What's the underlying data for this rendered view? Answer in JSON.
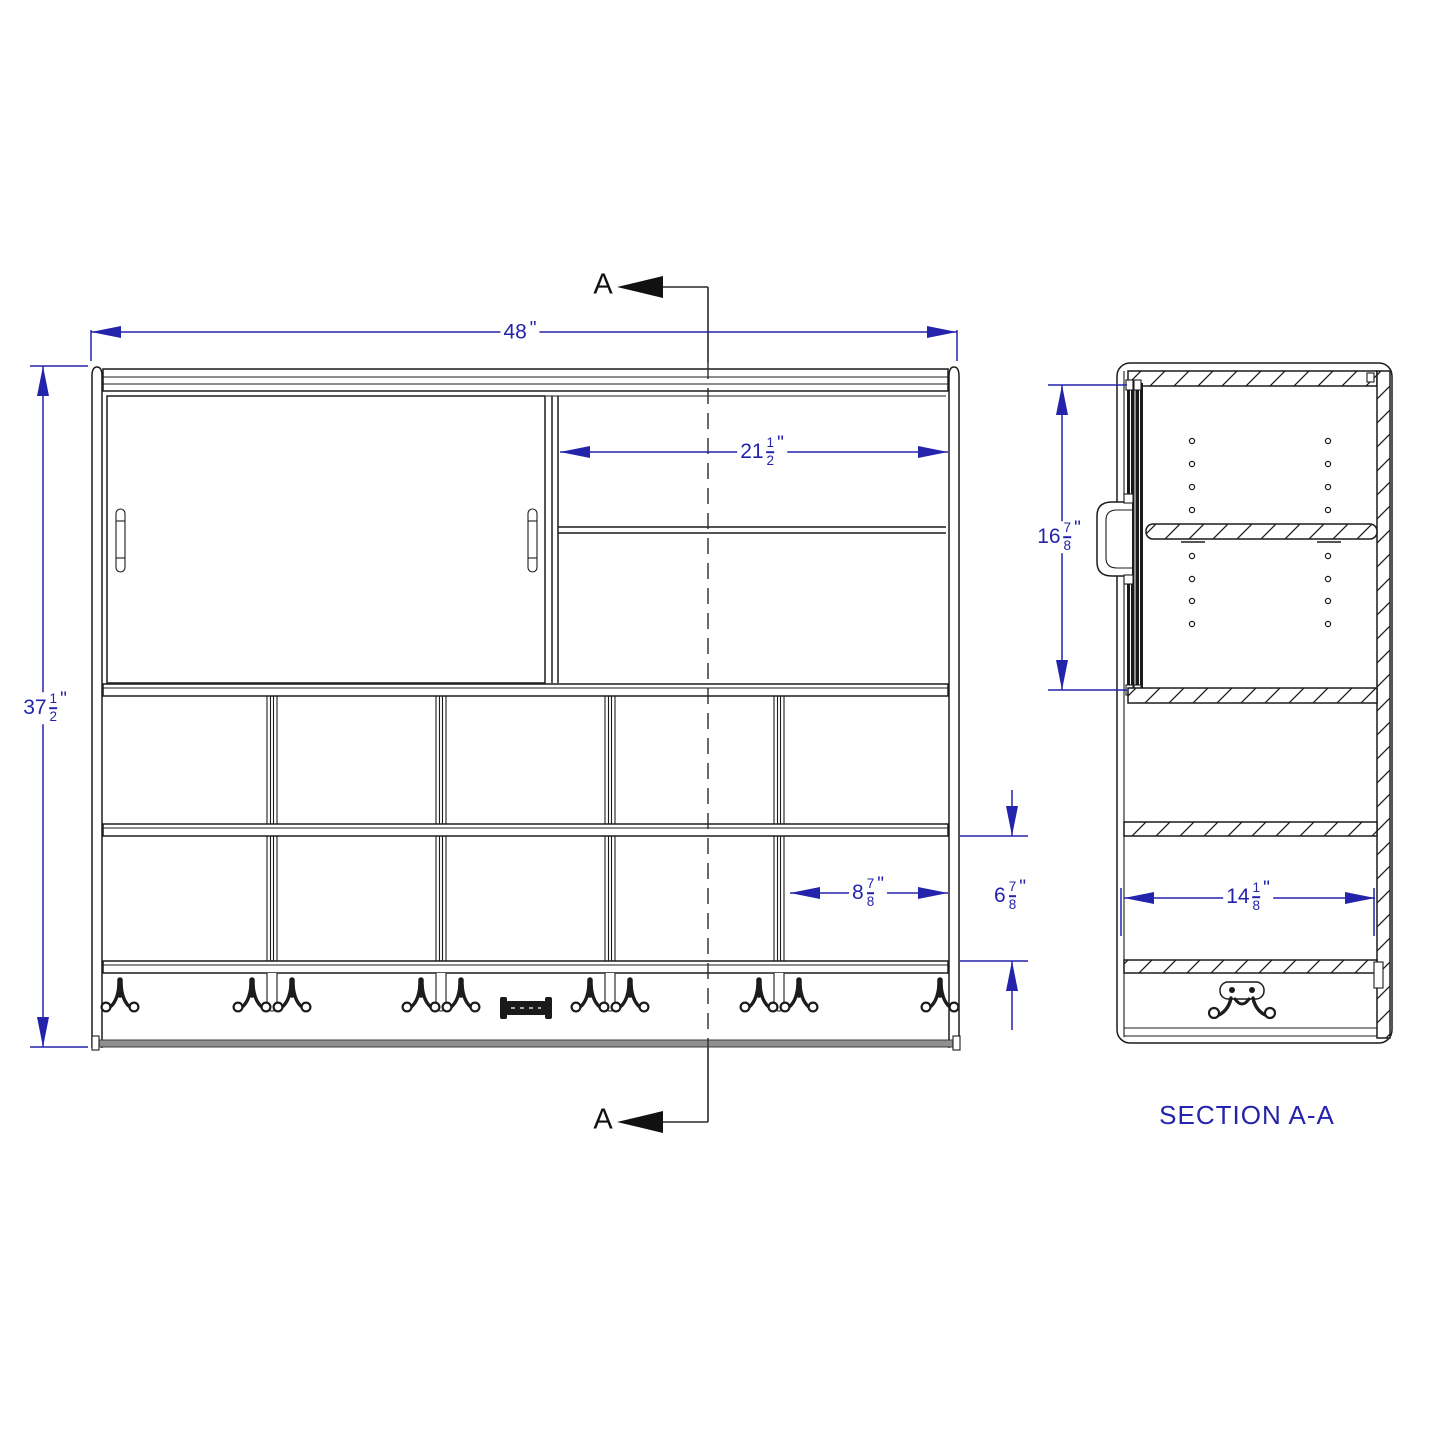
{
  "drawing": {
    "colors": {
      "dimension": "#2323ab",
      "line": "#1c1c1c",
      "rail_gray": "#8f8f8f"
    },
    "front_view": {
      "section_marker": "A",
      "dim_overall_width": {
        "whole": "48",
        "unit": "\""
      },
      "dim_overall_height": {
        "whole": "37",
        "num": "1",
        "den": "2",
        "unit": "\""
      },
      "dim_opening_width": {
        "whole": "21",
        "num": "1",
        "den": "2",
        "unit": "\""
      },
      "dim_cubby_width": {
        "whole": "8",
        "num": "7",
        "den": "8",
        "unit": "\""
      },
      "dim_cubby_height": {
        "whole": "6",
        "num": "7",
        "den": "8",
        "unit": "\""
      }
    },
    "section_view": {
      "title": "SECTION A-A",
      "dim_door_height": {
        "whole": "16",
        "num": "7",
        "den": "8",
        "unit": "\""
      },
      "dim_depth": {
        "whole": "14",
        "num": "1",
        "den": "8",
        "unit": "\""
      }
    }
  }
}
